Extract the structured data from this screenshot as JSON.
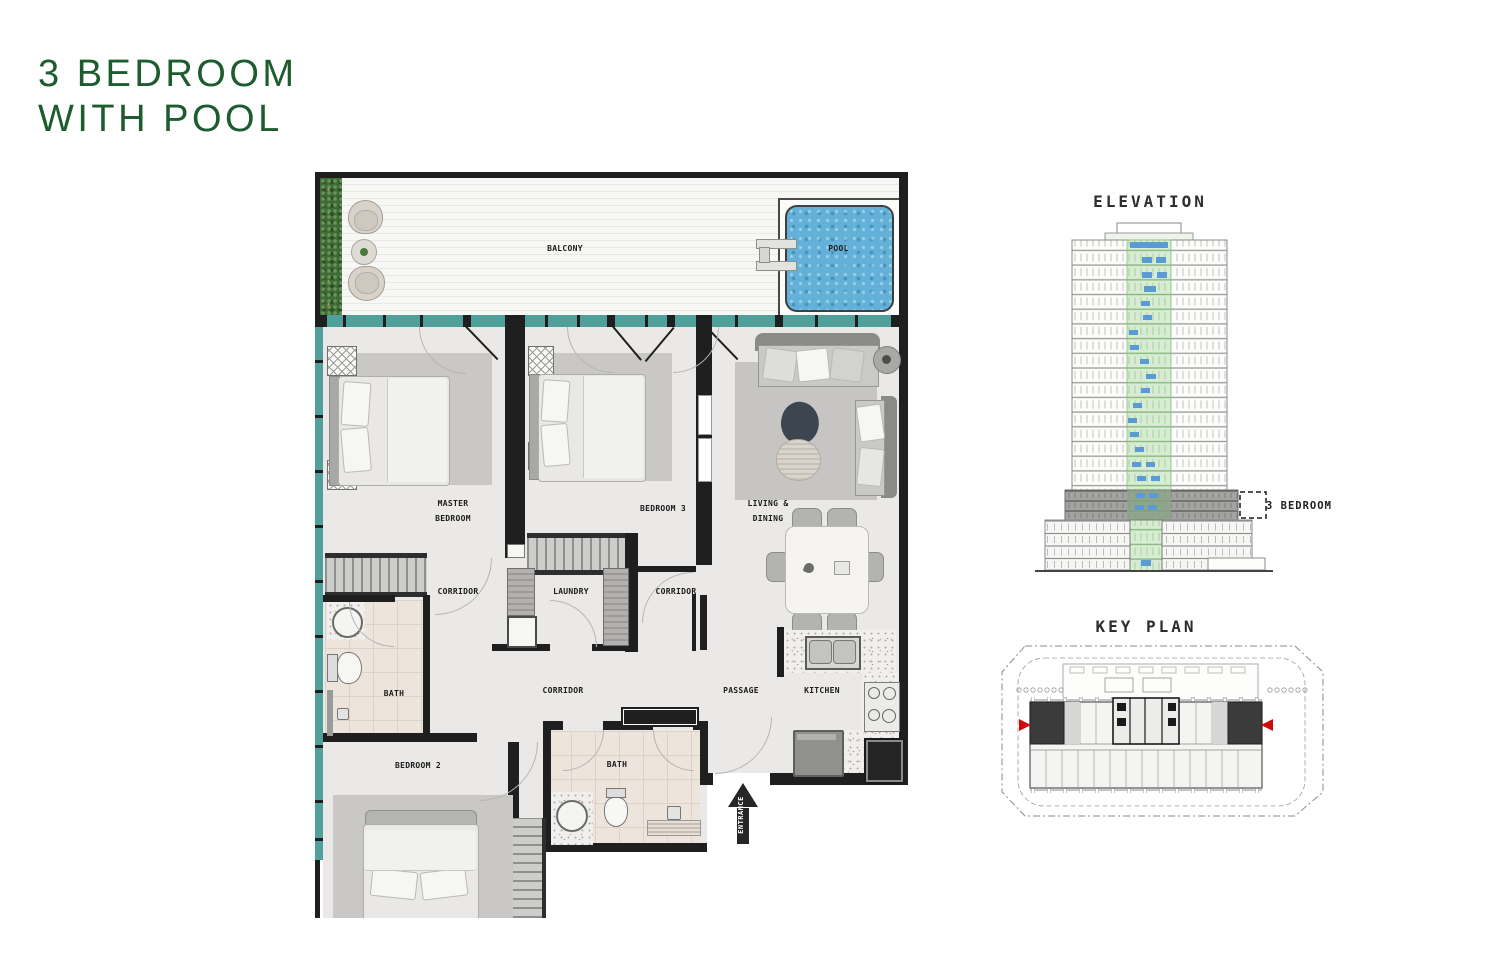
{
  "title": {
    "line1": "3 BEDROOM",
    "line2": "WITH POOL"
  },
  "floor_plan": {
    "labels": {
      "balcony": "BALCONY",
      "pool": "POOL",
      "master_bedroom": [
        "MASTER",
        "BEDROOM"
      ],
      "bedroom3": "BEDROOM 3",
      "living_dining": [
        "LIVING &",
        "DINING"
      ],
      "corridor_left": "CORRIDOR",
      "laundry": "LAUNDRY",
      "corridor_right": "CORRIDOR",
      "bath_master": "BATH",
      "corridor_main": "CORRIDOR",
      "passage": "PASSAGE",
      "kitchen": "KITCHEN",
      "bedroom2": "BEDROOM 2",
      "bath2": "BATH",
      "entrance": "ENTRANCE"
    }
  },
  "elevation": {
    "title": "ELEVATION",
    "annotation": "3 BEDROOM"
  },
  "key_plan": {
    "title": "KEY PLAN"
  },
  "colors": {
    "title_green": "#1d5c2f",
    "wall_black": "#1f1f1f",
    "glass_teal": "#4f9f9b",
    "pool_blue": "#63b1d8",
    "floor_gray": "#eae9e7",
    "bath_beige": "#ede4db",
    "elevation_highlight_green": "#d8ecd3",
    "elevation_window_blue": "#5b9bd5",
    "key_plan_marker_red": "#cf0a0a"
  }
}
